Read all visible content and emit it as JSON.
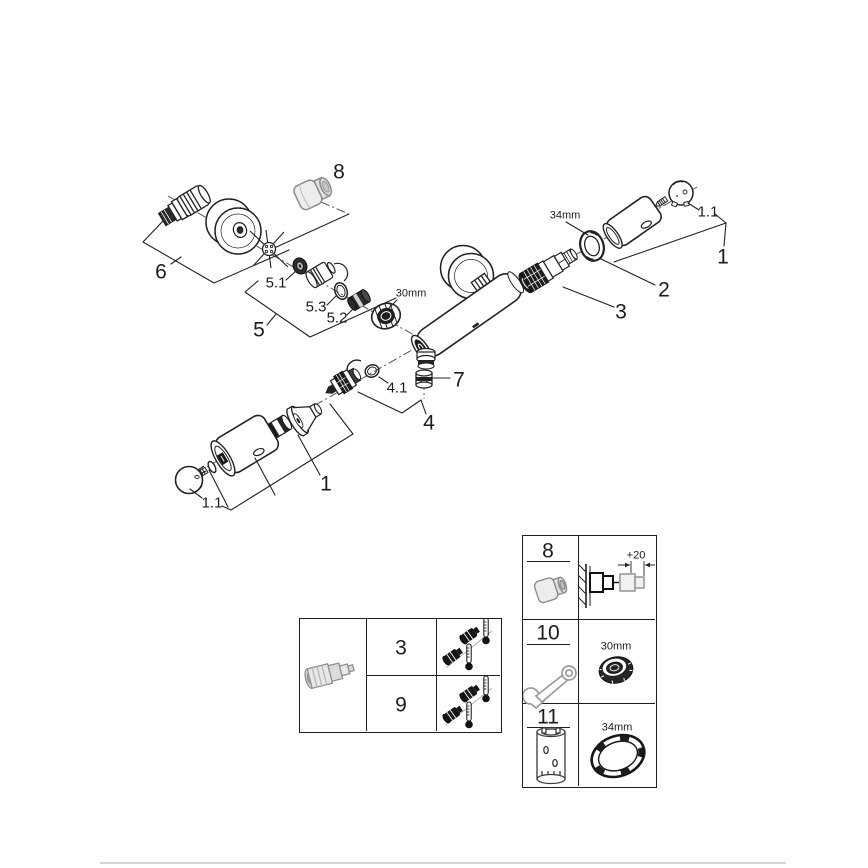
{
  "diagram": {
    "callouts": {
      "n8": "8",
      "n6": "6",
      "n5_1": "5.1",
      "n5_3": "5.3",
      "n5_2": "5.2",
      "n5": "5",
      "size30": "30mm",
      "n7": "7",
      "n4_1": "4.1",
      "n4": "4",
      "n1_bottom": "1",
      "n1_1_bottom": "1.1",
      "size34": "34mm",
      "n1_1_right": "1.1",
      "n1_right": "1",
      "n2": "2",
      "n3": "3"
    },
    "icons": {
      "parts": [
        "s-union-icon",
        "escutcheon-icon",
        "star-seal-icon",
        "washer-icon",
        "o-ring-icon",
        "aerator-insert-icon",
        "nut-30mm-icon",
        "extension-cap-icon",
        "mixer-body-icon",
        "cartridge-icon",
        "ring-nut-34mm-icon",
        "grip-cylinder-icon",
        "cover-cap-icon",
        "check-valve-icon",
        "outlet-nut-icon"
      ]
    }
  },
  "calibration_table": {
    "part_icon": "thermostatic-cartridge-icon",
    "row_icon": "cartridge-and-thermometer-icon",
    "rows": [
      {
        "ref": "3"
      },
      {
        "ref": "9"
      }
    ]
  },
  "tools_table": {
    "rows": [
      {
        "ref": "8",
        "icon": "extension-cap-icon",
        "dimension": "+20",
        "note_icon": "wall-extension-diagram-icon"
      },
      {
        "ref": "10",
        "icon": "wrench-icon",
        "size": "30mm",
        "size_icon": "nut-30mm-icon"
      },
      {
        "ref": "11",
        "icon": "socket-tool-icon",
        "size": "34mm",
        "size_icon": "ring-nut-34mm-icon"
      }
    ]
  },
  "colors": {
    "line": "#222222",
    "grey_part": "#8d8d8d",
    "divider": "#d6d6d6"
  }
}
